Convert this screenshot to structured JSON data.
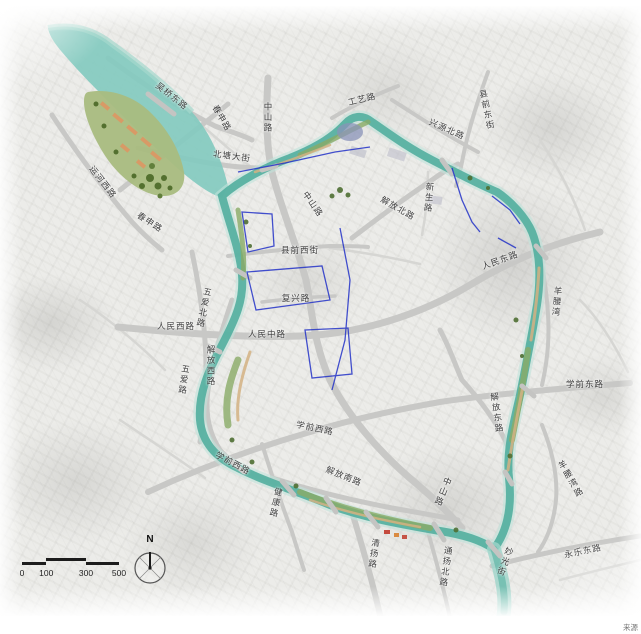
{
  "map": {
    "colors": {
      "canal_main": "#55b0a0",
      "canal_light": "#a5d8cd",
      "canal_core": "#7cc9ba",
      "lake": "#82cabf",
      "island_green": "#a9bc80",
      "road": "#c8c8c6",
      "road_minor": "#d6d6d3",
      "boundary_blue": "#2433c8",
      "label_text": "#3d3d3d",
      "background": "#ecece9"
    },
    "labels": [
      {
        "text": "吴桥东路",
        "x": 172,
        "y": 96,
        "rot": 38,
        "v": false
      },
      {
        "text": "春申路",
        "x": 222,
        "y": 118,
        "rot": 60,
        "v": false
      },
      {
        "text": "中山路",
        "x": 268,
        "y": 118,
        "rot": 0,
        "v": true
      },
      {
        "text": "北塘大街",
        "x": 232,
        "y": 156,
        "rot": 8,
        "v": false
      },
      {
        "text": "工艺路",
        "x": 362,
        "y": 99,
        "rot": -14,
        "v": false
      },
      {
        "text": "兴源北路",
        "x": 447,
        "y": 129,
        "rot": 24,
        "v": false
      },
      {
        "text": "县前东街",
        "x": 487,
        "y": 110,
        "rot": -12,
        "v": true
      },
      {
        "text": "运河西路",
        "x": 103,
        "y": 182,
        "rot": 52,
        "v": false
      },
      {
        "text": "春申路",
        "x": 150,
        "y": 222,
        "rot": 33,
        "v": false
      },
      {
        "text": "五爱北路",
        "x": 204,
        "y": 308,
        "rot": 12,
        "v": true
      },
      {
        "text": "五爱路",
        "x": 184,
        "y": 380,
        "rot": 8,
        "v": true
      },
      {
        "text": "人民西路",
        "x": 176,
        "y": 326,
        "rot": 0,
        "v": false
      },
      {
        "text": "人民中路",
        "x": 267,
        "y": 334,
        "rot": 0,
        "v": false
      },
      {
        "text": "县前西街",
        "x": 300,
        "y": 250,
        "rot": 0,
        "v": false
      },
      {
        "text": "复兴路",
        "x": 296,
        "y": 298,
        "rot": 0,
        "v": false
      },
      {
        "text": "中山路",
        "x": 313,
        "y": 204,
        "rot": 55,
        "v": false
      },
      {
        "text": "解放北路",
        "x": 398,
        "y": 208,
        "rot": 30,
        "v": false
      },
      {
        "text": "新生路",
        "x": 429,
        "y": 198,
        "rot": 5,
        "v": true
      },
      {
        "text": "人民东路",
        "x": 500,
        "y": 260,
        "rot": -20,
        "v": false
      },
      {
        "text": "羊腰湾",
        "x": 557,
        "y": 302,
        "rot": 5,
        "v": true
      },
      {
        "text": "学前东路",
        "x": 585,
        "y": 384,
        "rot": 0,
        "v": false
      },
      {
        "text": "解放东路",
        "x": 497,
        "y": 413,
        "rot": -8,
        "v": true
      },
      {
        "text": "学前西路",
        "x": 315,
        "y": 428,
        "rot": 12,
        "v": false
      },
      {
        "text": "学前西路",
        "x": 233,
        "y": 463,
        "rot": 28,
        "v": false
      },
      {
        "text": "解放西路",
        "x": 211,
        "y": 366,
        "rot": 0,
        "v": true
      },
      {
        "text": "健康路",
        "x": 276,
        "y": 503,
        "rot": 12,
        "v": true
      },
      {
        "text": "解放南路",
        "x": 344,
        "y": 476,
        "rot": 22,
        "v": false
      },
      {
        "text": "中山路",
        "x": 443,
        "y": 492,
        "rot": 22,
        "v": true
      },
      {
        "text": "清扬路",
        "x": 374,
        "y": 554,
        "rot": 8,
        "v": true
      },
      {
        "text": "通扬北路",
        "x": 446,
        "y": 567,
        "rot": 8,
        "v": true
      },
      {
        "text": "羊腰湾路",
        "x": 571,
        "y": 479,
        "rot": -30,
        "v": true
      },
      {
        "text": "妙光街",
        "x": 505,
        "y": 562,
        "rot": 20,
        "v": true
      },
      {
        "text": "永乐东路",
        "x": 583,
        "y": 551,
        "rot": -12,
        "v": false
      }
    ],
    "scale_bar": {
      "ticks": [
        "0",
        "100",
        "300",
        "500"
      ]
    },
    "compass": {
      "north_label": "N"
    },
    "watermark": "来源"
  }
}
